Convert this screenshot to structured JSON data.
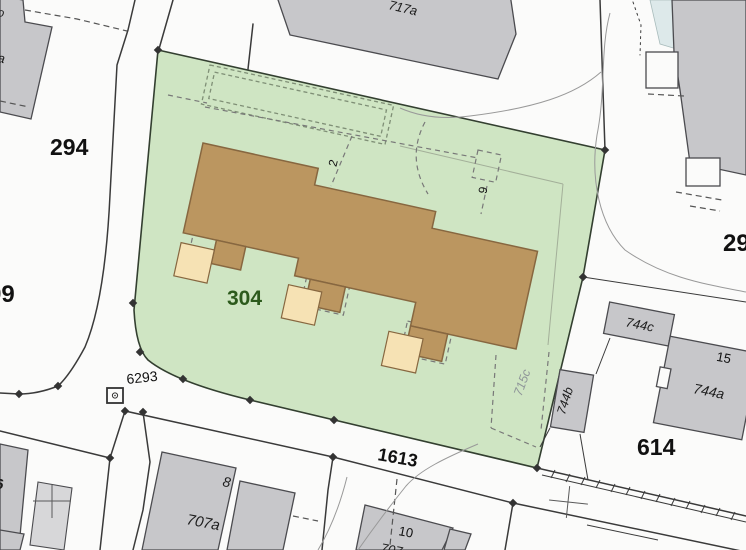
{
  "map": {
    "type": "cadastral-parcel-map",
    "selected_parcel": "304",
    "labels": {
      "p294": "294",
      "p304": "304",
      "p614": "614",
      "p1613": "1613",
      "p6293": "6293",
      "p99": "99",
      "p29": "29",
      "p715c": "715c",
      "b717a": "717a",
      "h707a": "707a",
      "h8": "8",
      "h10": "10",
      "h10_part": "707",
      "h6": "6",
      "b744a": "744a",
      "b744b": "744b",
      "b744c": "744c",
      "h15": "15",
      "h2": "2",
      "h9": "9",
      "frag_o": "o",
      "frag_a": "a"
    },
    "symbols": {
      "boundary_marker": "square-with-circle",
      "boundary_point": "diamond",
      "survey_cross": "plus-cross"
    },
    "colors": {
      "background": "#fbfbfa",
      "parcel_green_fill": "#cfe5c3",
      "parcel_green_border": "#333f30",
      "building_tan_fill": "#bb9660",
      "building_tan_border": "#876740",
      "porch_cream_fill": "#f6e2b4",
      "building_gray_fill": "#c7c7ca",
      "building_gray_light": "#d7d7d9",
      "building_gray_border": "#4b4b4f",
      "water_blue_fill": "#dde9ea",
      "road_line": "#3a3a3a",
      "thin_line": "#999999",
      "dash_line": "#787878",
      "garage_dash": "#7f8f76",
      "inner_line": "#a3af99",
      "label_black": "#111111",
      "label_green": "#2c5a1c",
      "label_gray": "#8f9699"
    }
  }
}
